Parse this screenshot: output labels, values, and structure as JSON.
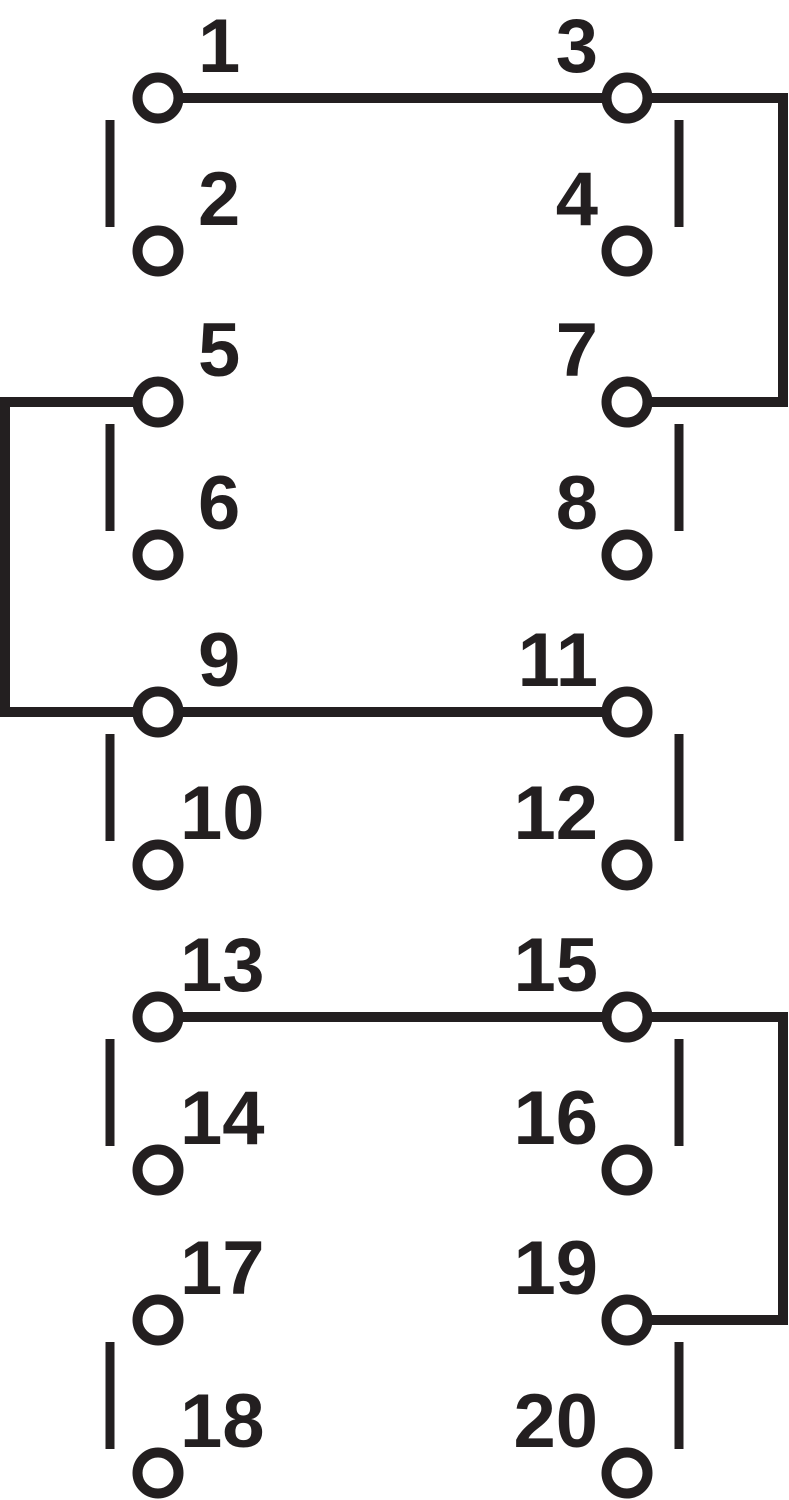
{
  "diagram": {
    "kind": "switch-wiring-schematic",
    "stroke_color": "#231f20",
    "background_color": "#ffffff",
    "terminals": {
      "t1": {
        "label": "1"
      },
      "t2": {
        "label": "2"
      },
      "t3": {
        "label": "3"
      },
      "t4": {
        "label": "4"
      },
      "t5": {
        "label": "5"
      },
      "t6": {
        "label": "6"
      },
      "t7": {
        "label": "7"
      },
      "t8": {
        "label": "8"
      },
      "t9": {
        "label": "9"
      },
      "t10": {
        "label": "10"
      },
      "t11": {
        "label": "11"
      },
      "t12": {
        "label": "12"
      },
      "t13": {
        "label": "13"
      },
      "t14": {
        "label": "14"
      },
      "t15": {
        "label": "15"
      },
      "t16": {
        "label": "16"
      },
      "t17": {
        "label": "17"
      },
      "t18": {
        "label": "18"
      },
      "t19": {
        "label": "19"
      },
      "t20": {
        "label": "20"
      }
    },
    "connections": [
      {
        "from": "1",
        "to": "3",
        "route": "direct-horizontal"
      },
      {
        "from": "3",
        "to": "7",
        "route": "right-edge"
      },
      {
        "from": "5",
        "to": "9",
        "route": "left-edge"
      },
      {
        "from": "9",
        "to": "11",
        "route": "direct-horizontal"
      },
      {
        "from": "13",
        "to": "15",
        "route": "direct-horizontal"
      },
      {
        "from": "15",
        "to": "19",
        "route": "right-edge"
      }
    ]
  }
}
